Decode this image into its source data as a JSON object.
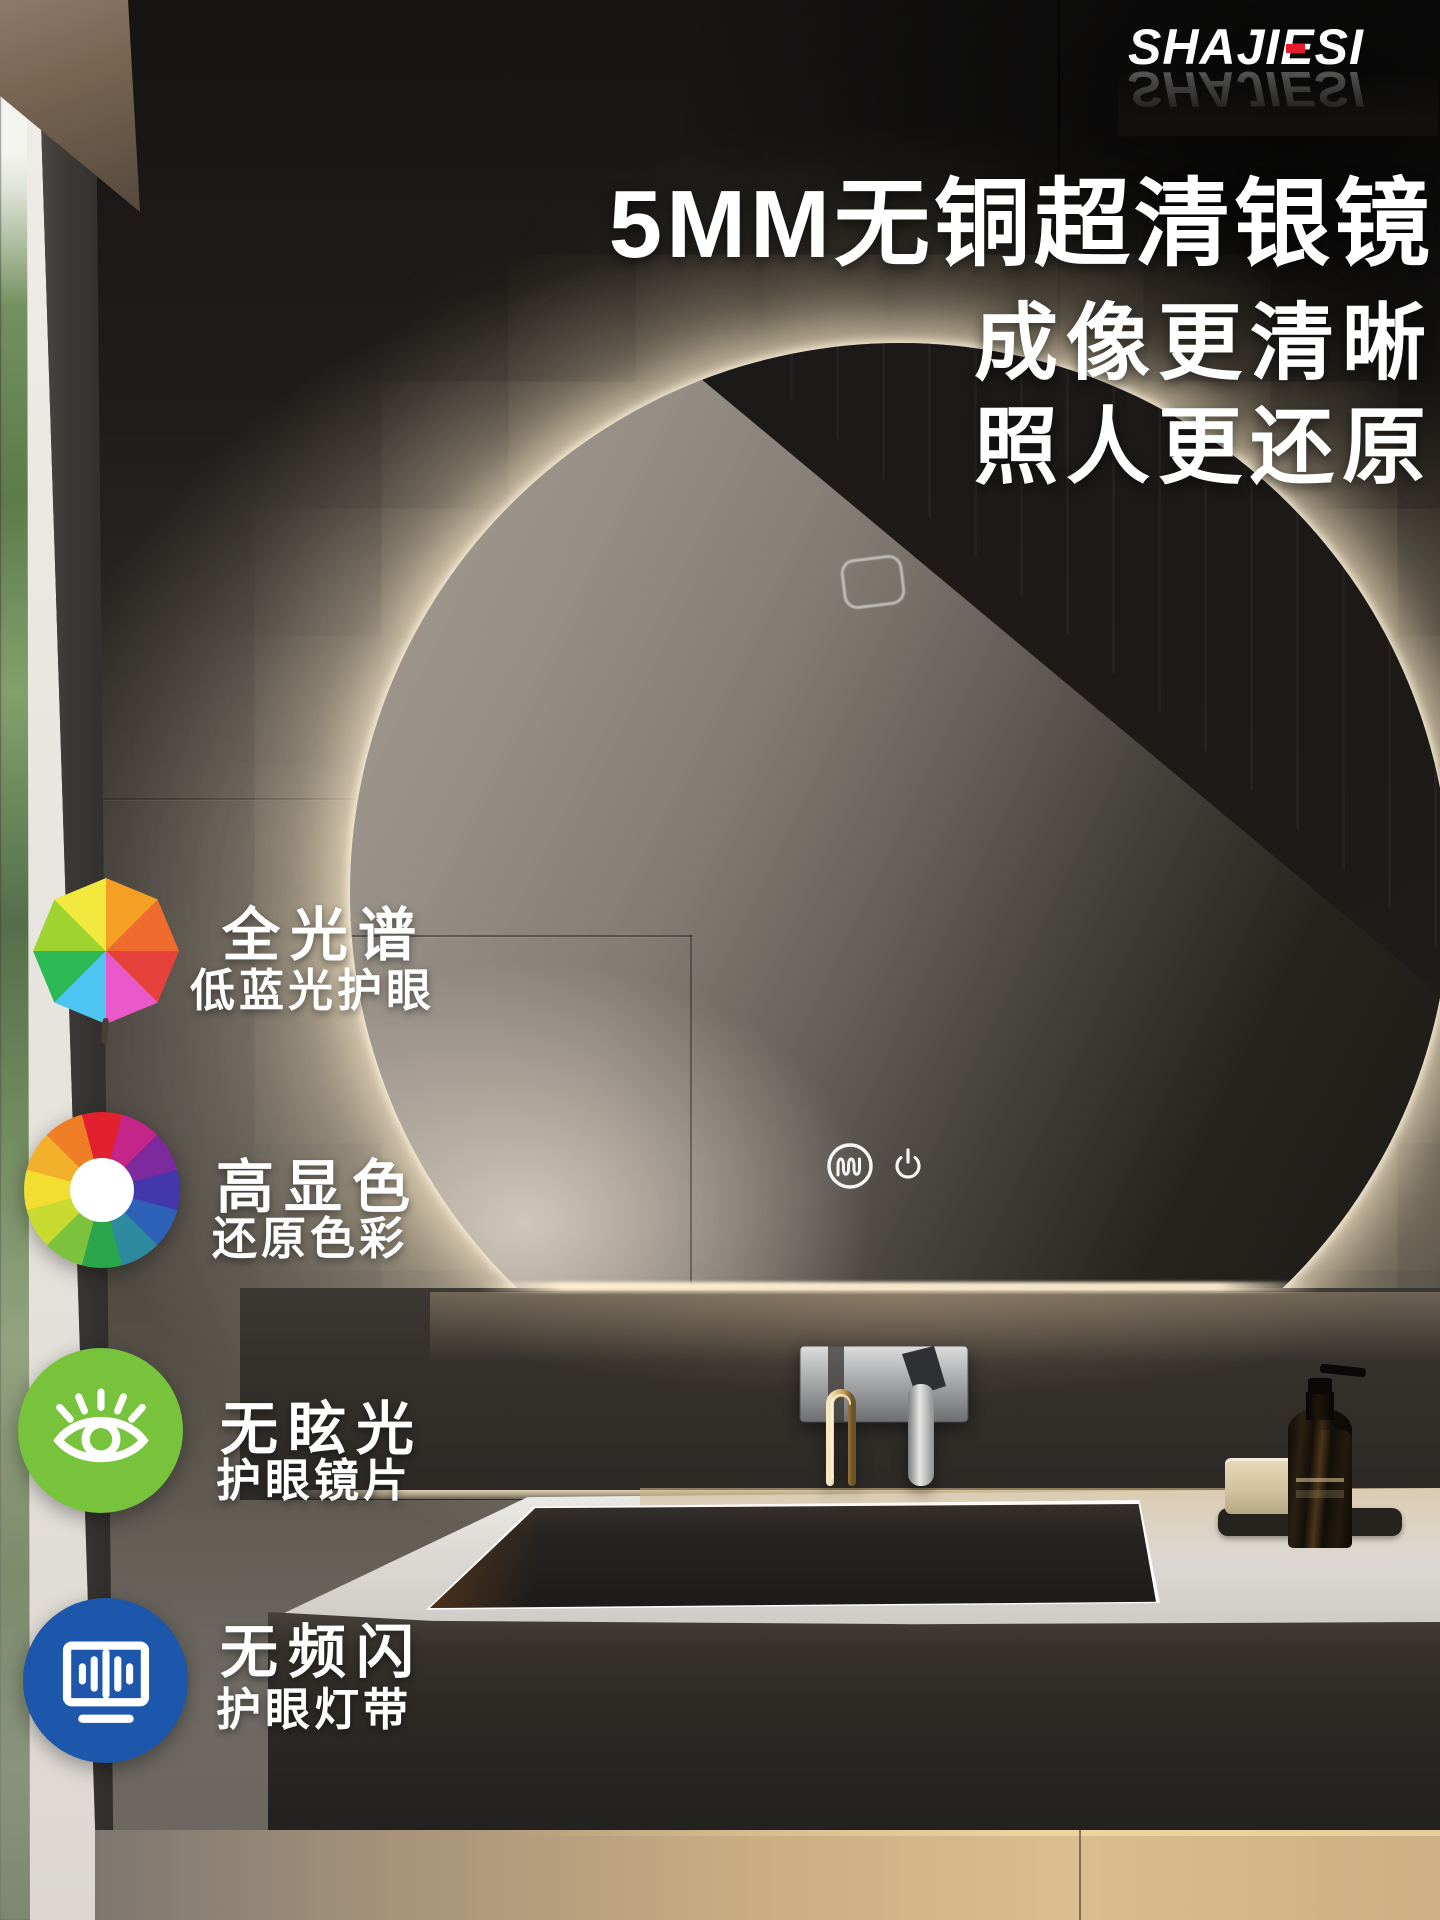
{
  "brand": {
    "logo": "SHAJIESI",
    "logo_left": "SHAJI",
    "logo_accent_letter": "E",
    "logo_right": "SI",
    "accent_color": "#e8192c"
  },
  "headline": {
    "title": "5MM无铜超清银镜",
    "subtitle_line1": "成像更清晰",
    "subtitle_line2": "照人更还原"
  },
  "features": [
    {
      "icon": "spectrum-umbrella-icon",
      "title": "全光谱",
      "subtitle": "低蓝光护眼",
      "colors": [
        "#f3a024",
        "#ee6a2d",
        "#e6413a",
        "#e959c9",
        "#4ec4f2",
        "#2cb852",
        "#9fd430",
        "#f3e93c"
      ]
    },
    {
      "icon": "color-wheel-icon",
      "title": "高显色",
      "subtitle": "还原色彩",
      "colors": [
        "#e3202e",
        "#c32588",
        "#7c2a9e",
        "#4436ab",
        "#2d62b8",
        "#2e8a9e",
        "#2aa64d",
        "#7dc23c",
        "#c8d92f",
        "#f2de30",
        "#f2b02a",
        "#ef7d26"
      ]
    },
    {
      "icon": "eye-icon",
      "title": "无眩光",
      "subtitle": "护眼镜片",
      "bg_color": "#77c33b"
    },
    {
      "icon": "flicker-free-screen-icon",
      "title": "无频闪",
      "subtitle": "护眼灯带",
      "bg_color": "#1c57ac"
    }
  ],
  "mirror": {
    "glow_color": "#ffe9c4",
    "touch_controls": [
      {
        "icon": "defog-icon"
      },
      {
        "icon": "power-icon"
      }
    ]
  }
}
